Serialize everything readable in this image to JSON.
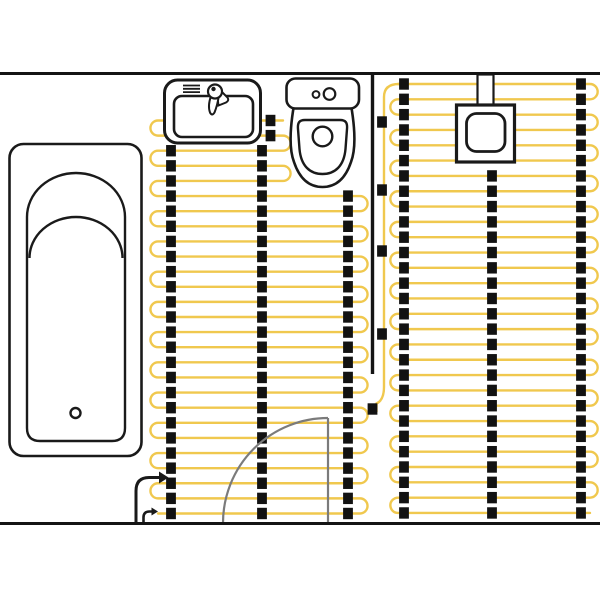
{
  "diagram": {
    "kind": "bathroom-underfloor-heating-floor-plan",
    "canvas": {
      "width": 600,
      "height": 600
    },
    "colors": {
      "background": "#ffffff",
      "cable": "#F0C84E",
      "strip": "#121212",
      "wall": "#141414",
      "fixture": "#1a1a1a",
      "door": "#7b7b7b"
    },
    "strip_size": {
      "w": 9.8,
      "h": 11.4
    },
    "mats": [
      {
        "name": "left-heating-mat",
        "rows": {
          "count": 27,
          "y0": 120.5,
          "pitch": 15.115
        },
        "x_start": 158,
        "x_end": 360,
        "short": {
          "from": 0,
          "to": 4,
          "x_end": 283
        },
        "left_pairs_from": 0,
        "right_pairs_from": 1,
        "columns": [
          {
            "x": 171,
            "from": 2,
            "to": 26
          },
          {
            "x": 262,
            "from": 2,
            "to": 26
          },
          {
            "x": 270.5,
            "from": 0,
            "to": 1
          },
          {
            "x": 348,
            "from": 5,
            "to": 26
          }
        ]
      },
      {
        "name": "right-heating-mat",
        "rows": {
          "count": 29,
          "y0": 84,
          "pitch": 15.32
        },
        "x_start": 398,
        "x_end": 590,
        "short": null,
        "left_pairs_from": 1,
        "right_pairs_from": 0,
        "columns": [
          {
            "x": 404,
            "from": 0,
            "to": 28
          },
          {
            "x": 492,
            "from": 6,
            "to": 28
          },
          {
            "x": 581,
            "from": 0,
            "to": 28
          }
        ]
      }
    ],
    "feed_line": {
      "name": "cold-lead-feed-line",
      "path": "M 399 84 Q 384 84 384 97 L 384 387 Q 384 400 376.5 403.5 L 376.5 412",
      "clips": [
        {
          "x": 382,
          "y": 122
        },
        {
          "x": 382,
          "y": 190
        },
        {
          "x": 382,
          "y": 251
        },
        {
          "x": 382,
          "y": 334
        },
        {
          "x": 372.5,
          "y": 409
        }
      ]
    },
    "shapes": [
      {
        "name": "bathtub-outline",
        "type": "rect",
        "x": 9.5,
        "y": 144,
        "w": 132,
        "h": 312,
        "rx": 14,
        "stroke": "fixture",
        "sw": 2.6,
        "fill": "#ffffff"
      },
      {
        "name": "bathtub-basin",
        "type": "path",
        "d": "M 27 217 A 49 44 0 0 1 125 217 L 125 428 Q 125 441 112 441 L 40 441 Q 27 441 27 428 Z",
        "stroke": "fixture",
        "sw": 2.4,
        "fill": "#ffffff"
      },
      {
        "name": "bathtub-headrest-arc",
        "type": "path",
        "d": "M 29.5 258 A 46.5 41 0 0 1 122.5 258",
        "stroke": "fixture",
        "sw": 2.4,
        "fill": "none"
      },
      {
        "name": "bathtub-drain",
        "type": "circle",
        "cx": 75.5,
        "cy": 413,
        "r": 5,
        "stroke": "fixture",
        "sw": 2.4,
        "fill": "#ffffff"
      },
      {
        "name": "sink-outline",
        "type": "rect",
        "x": 164.5,
        "y": 80,
        "w": 96,
        "h": 63,
        "rx": 13,
        "stroke": "fixture",
        "sw": 3,
        "fill": "#ffffff"
      },
      {
        "name": "sink-basin",
        "type": "rect",
        "x": 174,
        "y": 96,
        "w": 79,
        "h": 41,
        "rx": 8,
        "stroke": "fixture",
        "sw": 2.6,
        "fill": "#ffffff"
      },
      {
        "name": "sink-soap-ledge-lines",
        "type": "path",
        "d": "M 183 85.5 L 200 85.5 M 183 88.8 L 200 88.8 M 183 92.1 L 200 92.1",
        "stroke": "fixture",
        "sw": 1.8,
        "fill": "none"
      },
      {
        "name": "faucet-spout",
        "type": "path",
        "d": "M 216 86 L 227.5 97.5 Q 229.5 100.5 226 102.5 L 218.5 105.5 Z",
        "stroke": "fixture",
        "sw": 2,
        "fill": "#ffffff"
      },
      {
        "name": "faucet-lever",
        "type": "path",
        "d": "M 211 96 Q 207.5 106 210 112.5 Q 212 116.5 214.5 112.5 Q 217.5 105 218.8 96 Z",
        "stroke": "fixture",
        "sw": 2,
        "fill": "#ffffff"
      },
      {
        "name": "faucet-head",
        "type": "circle",
        "cx": 215,
        "cy": 91.5,
        "r": 7,
        "stroke": "fixture",
        "sw": 2.2,
        "fill": "#ffffff"
      },
      {
        "name": "faucet-dot",
        "type": "circle",
        "cx": 213.5,
        "cy": 89,
        "r": 2.2,
        "stroke": "none",
        "sw": 0,
        "fill": "#1a1a1a"
      },
      {
        "name": "toilet-bowl",
        "type": "path",
        "d": "M 294 105 C 290 128 289 149 294 162 C 300 180 310 187 322.5 187 C 335 187 345 180 351 162 C 356 149 355 128 351 105 Z",
        "stroke": "fixture",
        "sw": 2.6,
        "fill": "#ffffff"
      },
      {
        "name": "toilet-seat",
        "type": "path",
        "d": "M 305 120 L 340 120 C 346 120 347.5 123 347 129 L 345.5 149 C 344 166 335 174 322.5 174 C 310 174 301 166 299.5 149 L 298 129 C 297.5 123 299 120 305 120 Z",
        "stroke": "fixture",
        "sw": 2.4,
        "fill": "#ffffff"
      },
      {
        "name": "toilet-flush-hole",
        "type": "circle",
        "cx": 322.5,
        "cy": 136.5,
        "r": 9.8,
        "stroke": "fixture",
        "sw": 2.4,
        "fill": "#ffffff"
      },
      {
        "name": "toilet-tank",
        "type": "rect",
        "x": 286.5,
        "y": 78.5,
        "w": 72.5,
        "h": 30,
        "rx": 9,
        "stroke": "fixture",
        "sw": 2.6,
        "fill": "#ffffff"
      },
      {
        "name": "toilet-button-small",
        "type": "circle",
        "cx": 316,
        "cy": 94.5,
        "r": 3.4,
        "stroke": "fixture",
        "sw": 2,
        "fill": "#ffffff"
      },
      {
        "name": "toilet-button-large",
        "type": "circle",
        "cx": 329.5,
        "cy": 94,
        "r": 5.8,
        "stroke": "fixture",
        "sw": 2.2,
        "fill": "#ffffff"
      },
      {
        "name": "thermostat-stem",
        "type": "rect",
        "x": 477.5,
        "y": 74.5,
        "w": 16,
        "h": 31.5,
        "rx": 0,
        "stroke": "fixture",
        "sw": 2.2,
        "fill": "#ffffff"
      },
      {
        "name": "thermostat-box",
        "type": "rect",
        "x": 456.5,
        "y": 105,
        "w": 58,
        "h": 57,
        "rx": 0,
        "stroke": "fixture",
        "sw": 3.2,
        "fill": "#ffffff"
      },
      {
        "name": "thermostat-dial",
        "type": "rect",
        "x": 466.5,
        "y": 113.5,
        "w": 38.5,
        "h": 38,
        "rx": 10,
        "stroke": "fixture",
        "sw": 2.8,
        "fill": "#ffffff"
      },
      {
        "name": "door-swing-arc",
        "type": "path",
        "d": "M 223 523 A 105 105 0 0 1 328 418",
        "stroke": "door",
        "sw": 2.2,
        "fill": "none"
      },
      {
        "name": "door-leaf",
        "type": "path",
        "d": "M 328 418 L 328 523",
        "stroke": "door",
        "sw": 2.2,
        "fill": "none"
      },
      {
        "name": "power-lead-main",
        "type": "path",
        "d": "M 136 524 L 136 491 Q 136 477.5 149 477.5 L 159 477.5",
        "stroke": "fixture",
        "sw": 3,
        "fill": "none"
      },
      {
        "name": "power-lead-main-arrow",
        "type": "path",
        "d": "M 159 471.5 L 168.5 477.5 L 159 483.5 Z",
        "stroke": "none",
        "sw": 0,
        "fill": "#1a1a1a"
      },
      {
        "name": "power-lead-small",
        "type": "path",
        "d": "M 143.5 524 L 143.5 517.5 Q 143.5 511.5 149.5 511.5 L 151.5 511.5",
        "stroke": "fixture",
        "sw": 2.6,
        "fill": "none"
      },
      {
        "name": "power-lead-small-arrow",
        "type": "path",
        "d": "M 151.5 507.5 L 158 511.5 L 151.5 515.5 Z",
        "stroke": "none",
        "sw": 0,
        "fill": "#1a1a1a"
      },
      {
        "name": "wall-top",
        "type": "path",
        "d": "M 0 73.5 L 600 73.5",
        "stroke": "wall",
        "sw": 3,
        "fill": "none"
      },
      {
        "name": "wall-bottom",
        "type": "path",
        "d": "M 0 523.5 L 600 523.5",
        "stroke": "wall",
        "sw": 3,
        "fill": "none"
      },
      {
        "name": "wall-partition",
        "type": "path",
        "d": "M 372.5 73.5 L 372.5 374",
        "stroke": "wall",
        "sw": 3.4,
        "fill": "none"
      }
    ]
  }
}
